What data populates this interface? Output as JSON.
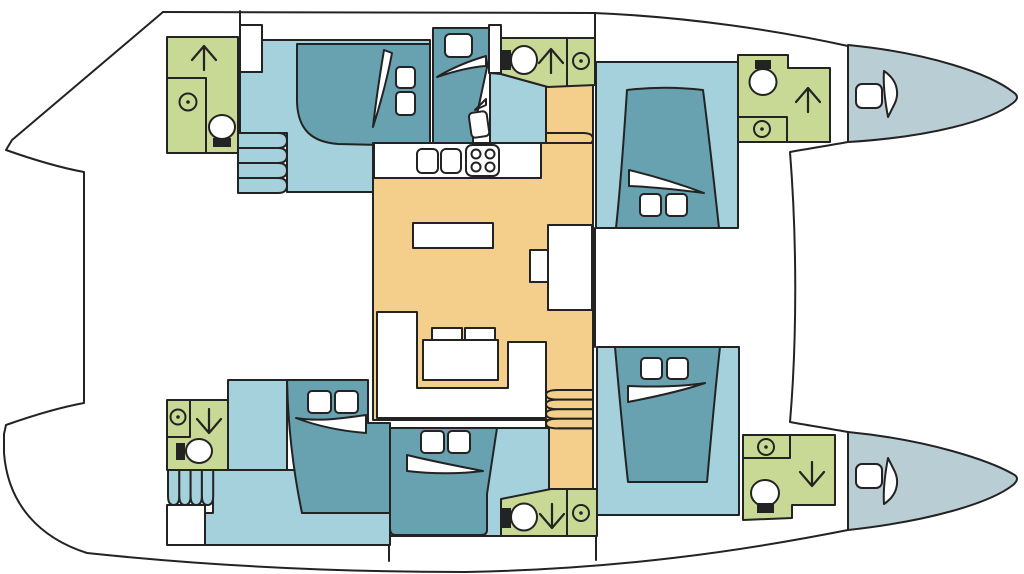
{
  "vessel": {
    "type": "catamaran-interior-deck-plan",
    "orientation": "bow-right",
    "hulls": 2,
    "cabins": 6,
    "heads": 6
  },
  "colors": {
    "line": "#232323",
    "floor": "#a4d1dc",
    "bed": "#68a1b0",
    "bath": "#c7d995",
    "salon": "#f4cf8b",
    "bow": "#b9cdd5",
    "white": "#ffffff"
  },
  "rooms": [
    {
      "id": "head-aft-top",
      "fixtures": [
        "shower",
        "washbasin",
        "toilet"
      ]
    },
    {
      "id": "cabin-aft-top",
      "features": [
        "double-berth",
        "two-pillows",
        "hull-steps"
      ]
    },
    {
      "id": "berth-mid-top",
      "features": [
        "single-berth",
        "two-pillows"
      ]
    },
    {
      "id": "head-mid-top",
      "fixtures": [
        "toilet",
        "shower",
        "washbasin"
      ]
    },
    {
      "id": "cabin-forward-top",
      "features": [
        "island-double-berth",
        "two-pillows"
      ]
    },
    {
      "id": "head-forward-top",
      "fixtures": [
        "toilet",
        "shower",
        "washbasin"
      ]
    },
    {
      "id": "forepeak-top",
      "features": [
        "deck-hatch"
      ]
    },
    {
      "id": "salon",
      "features": [
        "galley-counter",
        "galley-sink",
        "stove",
        "dinette-table",
        "u-shaped-sofa",
        "coffee-table",
        "nav-desk",
        "companionway-stairs-fwd",
        "companionway-stairs-aft"
      ]
    },
    {
      "id": "head-mid-bottom",
      "fixtures": [
        "toilet",
        "shower",
        "washbasin"
      ]
    },
    {
      "id": "cabin-mid-bottom",
      "features": [
        "double-berth",
        "two-pillows"
      ]
    },
    {
      "id": "cabin-aft-bottom",
      "features": [
        "double-berth",
        "two-pillows",
        "hull-steps"
      ]
    },
    {
      "id": "head-aft-bottom",
      "fixtures": [
        "washbasin",
        "shower",
        "toilet"
      ]
    },
    {
      "id": "cabin-forward-bottom",
      "features": [
        "island-double-berth",
        "two-pillows"
      ]
    },
    {
      "id": "head-forward-bottom",
      "fixtures": [
        "washbasin",
        "shower",
        "toilet"
      ]
    },
    {
      "id": "forepeak-bottom",
      "features": [
        "deck-hatch"
      ]
    }
  ]
}
